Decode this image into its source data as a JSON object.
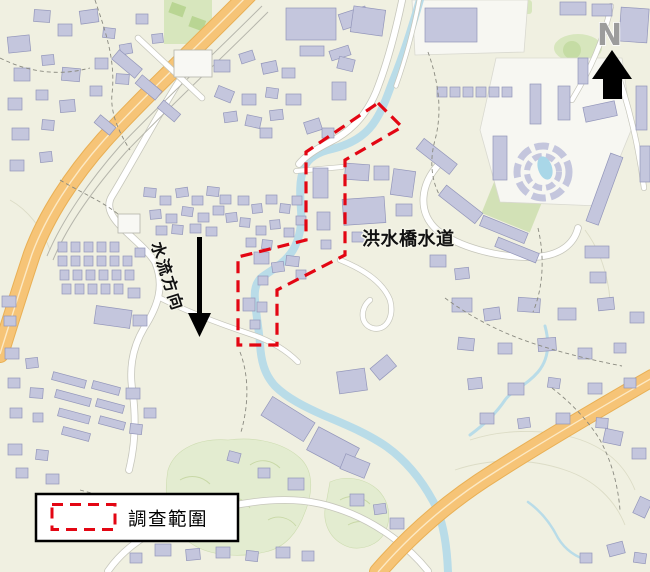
{
  "map": {
    "labels": {
      "watercourse": "洪水橋水道",
      "flow_direction": "水流方向",
      "north": "N"
    },
    "legend": {
      "symbol": "red-dashed-rectangle",
      "label": "調查範圍"
    },
    "colors": {
      "background": "#f0f0e1",
      "building_fill": "#c4c6dd",
      "building_outline": "#9396ba",
      "road_fill": "#ffffff",
      "road_casing": "#c6c6bb",
      "highway_fill": "#f6c477",
      "highway_casing": "#e9b055",
      "water": "#b9dce8",
      "pool": "#a9d7e8",
      "green_area": "#d7e6bd",
      "woodland": "#e3ecd0",
      "survey_boundary": "#e30613",
      "flow_arrow": "#000000",
      "north_letter": "#9c9c9c"
    }
  }
}
